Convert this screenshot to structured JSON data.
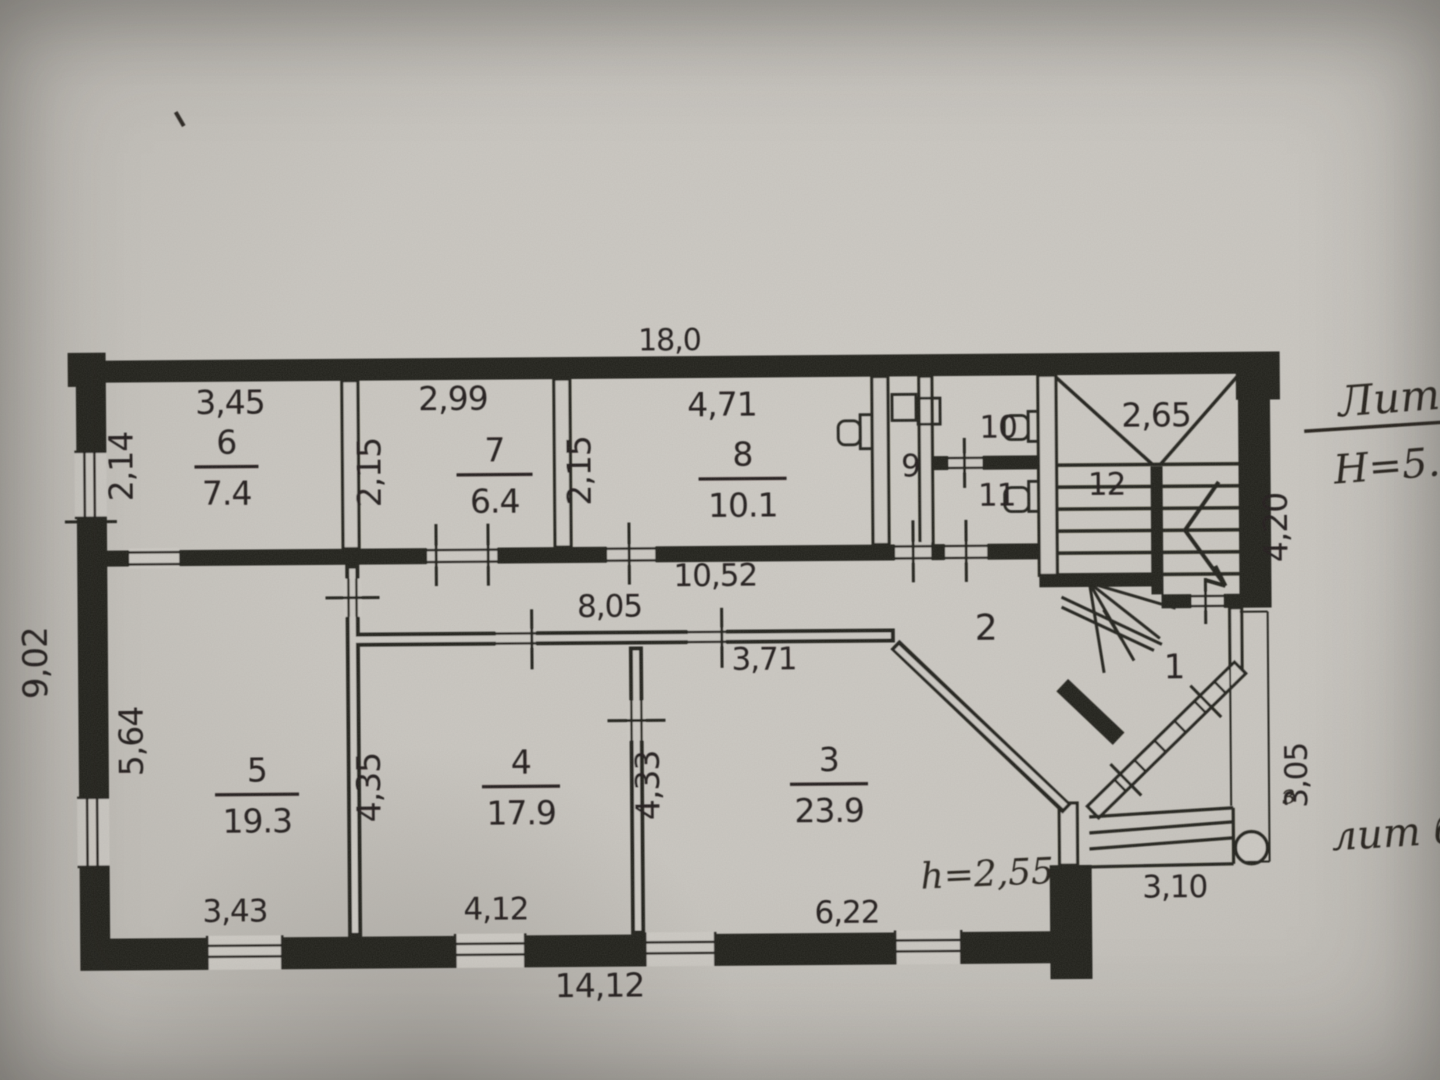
{
  "document": {
    "type": "scanned BTI floor plan",
    "litera_title": "Лит",
    "building_height": "Н=5.6",
    "annex_label": "лит б",
    "annex_mark": "з",
    "ceiling_height_note": "h=2,55"
  },
  "colors": {
    "paper": "#cdcac4",
    "ink": "#23211d"
  },
  "plan": {
    "overall": {
      "top": "18,0",
      "left": "9,02",
      "bottom": "14,12",
      "right_upper": "4,20",
      "right_lower": "3,05",
      "porch": "3,10"
    },
    "rooms": [
      {
        "num": "6",
        "area": "7.4",
        "x": 228,
        "y": 450,
        "w": 64
      },
      {
        "num": "7",
        "area": "6.4",
        "x": 496,
        "y": 460,
        "w": 76
      },
      {
        "num": "8",
        "area": "10.1",
        "x": 744,
        "y": 466,
        "w": 88
      },
      {
        "num": "5",
        "area": "19.3",
        "x": 256,
        "y": 778,
        "w": 84
      },
      {
        "num": "4",
        "area": "17.9",
        "x": 520,
        "y": 772,
        "w": 78
      },
      {
        "num": "3",
        "area": "23.9",
        "x": 828,
        "y": 772,
        "w": 78
      }
    ],
    "numbers": [
      {
        "t": "9",
        "x": 912,
        "y": 478
      },
      {
        "t": "10",
        "x": 1000,
        "y": 440
      },
      {
        "t": "11",
        "x": 998,
        "y": 508
      },
      {
        "t": "12",
        "x": 1108,
        "y": 498
      },
      {
        "t": "2",
        "x": 986,
        "y": 642,
        "s": 36
      },
      {
        "t": "1",
        "x": 1174,
        "y": 682,
        "s": 34
      }
    ],
    "dims": [
      {
        "t": "18,0",
        "x": 672,
        "y": 350,
        "s": 30
      },
      {
        "t": "3,45",
        "x": 232,
        "y": 410,
        "s": 33
      },
      {
        "t": "2,99",
        "x": 455,
        "y": 408,
        "s": 33
      },
      {
        "t": "4,71",
        "x": 724,
        "y": 416,
        "s": 33
      },
      {
        "t": "2,65",
        "x": 1158,
        "y": 430,
        "s": 33
      },
      {
        "t": "2,14",
        "x": 134,
        "y": 462,
        "s": 33,
        "r": 1
      },
      {
        "t": "2,15",
        "x": 382,
        "y": 470,
        "s": 33,
        "r": 1
      },
      {
        "t": "2,15",
        "x": 592,
        "y": 470,
        "s": 33,
        "r": 1
      },
      {
        "t": "10,52",
        "x": 716,
        "y": 586,
        "s": 31
      },
      {
        "t": "8,05",
        "x": 610,
        "y": 616,
        "s": 31
      },
      {
        "t": "3,71",
        "x": 764,
        "y": 670,
        "s": 31
      },
      {
        "t": "9,02",
        "x": 47,
        "y": 658,
        "s": 34,
        "r": 1
      },
      {
        "t": "5,64",
        "x": 142,
        "y": 737,
        "s": 33,
        "r": 1
      },
      {
        "t": "4,35",
        "x": 379,
        "y": 785,
        "s": 33,
        "r": 1
      },
      {
        "t": "4,33",
        "x": 658,
        "y": 785,
        "s": 33,
        "r": 1
      },
      {
        "t": "4,20",
        "x": 1288,
        "y": 532,
        "s": 33,
        "r": 1
      },
      {
        "t": "3,05",
        "x": 1306,
        "y": 780,
        "s": 31,
        "r": 1
      },
      {
        "t": "3,43",
        "x": 233,
        "y": 918,
        "s": 31
      },
      {
        "t": "4,12",
        "x": 494,
        "y": 918,
        "s": 31
      },
      {
        "t": "6,22",
        "x": 845,
        "y": 924,
        "s": 31
      },
      {
        "t": "14,12",
        "x": 597,
        "y": 996,
        "s": 33
      },
      {
        "t": "3,10",
        "x": 1173,
        "y": 901,
        "s": 31
      }
    ],
    "hand": [
      {
        "t": "Лит",
        "x": 1392,
        "y": 418,
        "s": 42,
        "rot": -4
      },
      {
        "t": "Н=5.6",
        "x": 1402,
        "y": 484,
        "s": 40,
        "rot": -4
      },
      {
        "t": "h=2,55",
        "x": 986,
        "y": 888,
        "s": 36,
        "rot": -2
      },
      {
        "t": "лит б",
        "x": 1394,
        "y": 852,
        "s": 40,
        "rot": -3
      },
      {
        "t": "з",
        "x": 1288,
        "y": 808,
        "s": 26,
        "rot": -6
      }
    ]
  }
}
